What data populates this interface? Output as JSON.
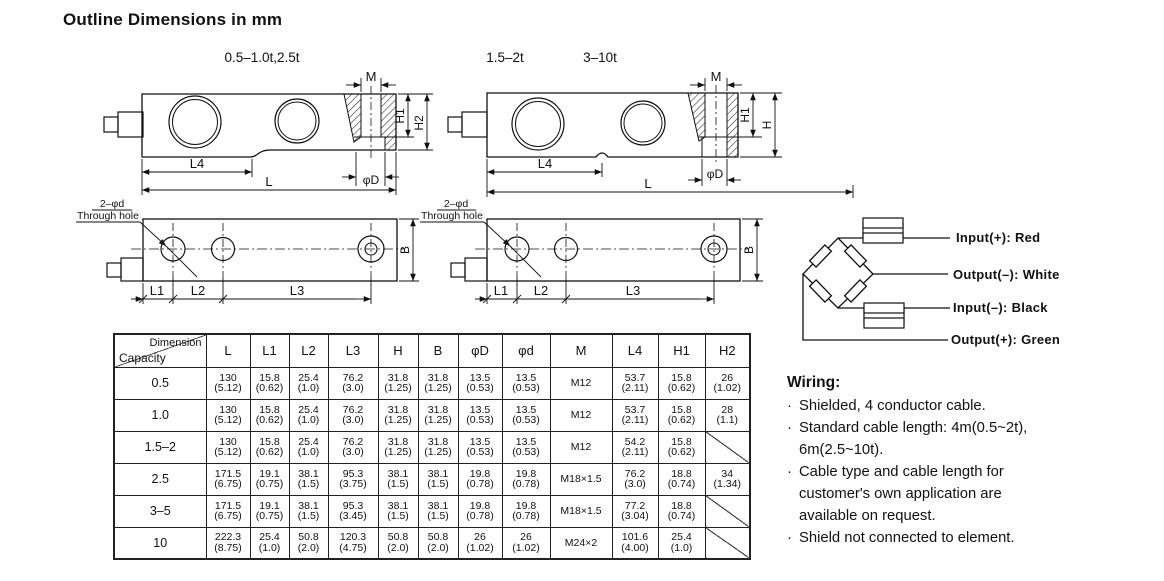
{
  "title": "Outline Dimensions in mm",
  "variants": {
    "small": "0.5–1.0t,2.5t",
    "medium": "1.5–2t",
    "large": "3–10t"
  },
  "drawings": {
    "side_small": {
      "M": "M",
      "H1": "H1",
      "H2": "H2",
      "L4": "L4",
      "L": "L",
      "phiD": "φD"
    },
    "side_large": {
      "M": "M",
      "H1": "H1",
      "H": "H",
      "L4": "L4",
      "L": "L",
      "phiD": "φD"
    },
    "top_small": {
      "callout1": "2–φd",
      "callout2": "Through hole",
      "L1": "L1",
      "L2": "L2",
      "L3": "L3",
      "B": "B"
    },
    "top_large": {
      "callout1": "2–φd",
      "callout2": "Through hole",
      "L1": "L1",
      "L2": "L2",
      "L3": "L3",
      "B": "B"
    }
  },
  "bridge": {
    "input_pos": "Input(+): Red",
    "output_neg": "Output(–): White",
    "input_neg": "Input(–): Black",
    "output_pos": "Output(+): Green"
  },
  "table": {
    "corner": {
      "top": "Dimension",
      "bottom": "Capacity"
    },
    "headers": [
      "L",
      "L1",
      "L2",
      "L3",
      "H",
      "B",
      "φD",
      "φd",
      "M",
      "L4",
      "H1",
      "H2"
    ],
    "rows": [
      {
        "capacity": "0.5",
        "cells": [
          [
            "130",
            "(5.12)"
          ],
          [
            "15.8",
            "(0.62)"
          ],
          [
            "25.4",
            "(1.0)"
          ],
          [
            "76.2",
            "(3.0)"
          ],
          [
            "31.8",
            "(1.25)"
          ],
          [
            "31.8",
            "(1.25)"
          ],
          [
            "13.5",
            "(0.53)"
          ],
          [
            "13.5",
            "(0.53)"
          ],
          [
            "M12",
            ""
          ],
          [
            "53.7",
            "(2.11)"
          ],
          [
            "15.8",
            "(0.62)"
          ],
          [
            "26",
            "(1.02)"
          ]
        ]
      },
      {
        "capacity": "1.0",
        "cells": [
          [
            "130",
            "(5.12)"
          ],
          [
            "15.8",
            "(0.62)"
          ],
          [
            "25.4",
            "(1.0)"
          ],
          [
            "76.2",
            "(3.0)"
          ],
          [
            "31.8",
            "(1.25)"
          ],
          [
            "31.8",
            "(1.25)"
          ],
          [
            "13.5",
            "(0.53)"
          ],
          [
            "13.5",
            "(0.53)"
          ],
          [
            "M12",
            ""
          ],
          [
            "53.7",
            "(2.11)"
          ],
          [
            "15.8",
            "(0.62)"
          ],
          [
            "28",
            "(1.1)"
          ]
        ]
      },
      {
        "capacity": "1.5–2",
        "cells": [
          [
            "130",
            "(5.12)"
          ],
          [
            "15.8",
            "(0.62)"
          ],
          [
            "25.4",
            "(1.0)"
          ],
          [
            "76.2",
            "(3.0)"
          ],
          [
            "31.8",
            "(1.25)"
          ],
          [
            "31.8",
            "(1.25)"
          ],
          [
            "13.5",
            "(0.53)"
          ],
          [
            "13.5",
            "(0.53)"
          ],
          [
            "M12",
            ""
          ],
          [
            "54.2",
            "(2.11)"
          ],
          [
            "15.8",
            "(0.62)"
          ],
          [
            "",
            ""
          ]
        ]
      },
      {
        "capacity": "2.5",
        "cells": [
          [
            "171.5",
            "(6.75)"
          ],
          [
            "19.1",
            "(0.75)"
          ],
          [
            "38.1",
            "(1.5)"
          ],
          [
            "95.3",
            "(3.75)"
          ],
          [
            "38.1",
            "(1.5)"
          ],
          [
            "38.1",
            "(1.5)"
          ],
          [
            "19.8",
            "(0.78)"
          ],
          [
            "19.8",
            "(0.78)"
          ],
          [
            "M18×1.5",
            ""
          ],
          [
            "76.2",
            "(3.0)"
          ],
          [
            "18.8",
            "(0.74)"
          ],
          [
            "34",
            "(1.34)"
          ]
        ]
      },
      {
        "capacity": "3–5",
        "cells": [
          [
            "171.5",
            "(6.75)"
          ],
          [
            "19.1",
            "(0.75)"
          ],
          [
            "38.1",
            "(1.5)"
          ],
          [
            "95.3",
            "(3.45)"
          ],
          [
            "38.1",
            "(1.5)"
          ],
          [
            "38.1",
            "(1.5)"
          ],
          [
            "19.8",
            "(0.78)"
          ],
          [
            "19.8",
            "(0.78)"
          ],
          [
            "M18×1.5",
            ""
          ],
          [
            "77.2",
            "(3.04)"
          ],
          [
            "18.8",
            "(0.74)"
          ],
          [
            "",
            ""
          ]
        ]
      },
      {
        "capacity": "10",
        "cells": [
          [
            "222.3",
            "(8.75)"
          ],
          [
            "25.4",
            "(1.0)"
          ],
          [
            "50.8",
            "(2.0)"
          ],
          [
            "120.3",
            "(4.75)"
          ],
          [
            "50.8",
            "(2.0)"
          ],
          [
            "50.8",
            "(2.0)"
          ],
          [
            "26",
            "(1.02)"
          ],
          [
            "26",
            "(1.02)"
          ],
          [
            "M24×2",
            ""
          ],
          [
            "101.6",
            "(4.00)"
          ],
          [
            "25.4",
            "(1.0)"
          ],
          [
            "",
            ""
          ]
        ]
      }
    ]
  },
  "wiring": {
    "heading": "Wiring:",
    "bullet": "·",
    "items": [
      "Shielded, 4 conductor cable.",
      "Standard cable length: 4m(0.5~2t), 6m(2.5~10t).",
      "Cable type and cable length for customer's own application are available on request.",
      "Shield not connected to element."
    ]
  }
}
